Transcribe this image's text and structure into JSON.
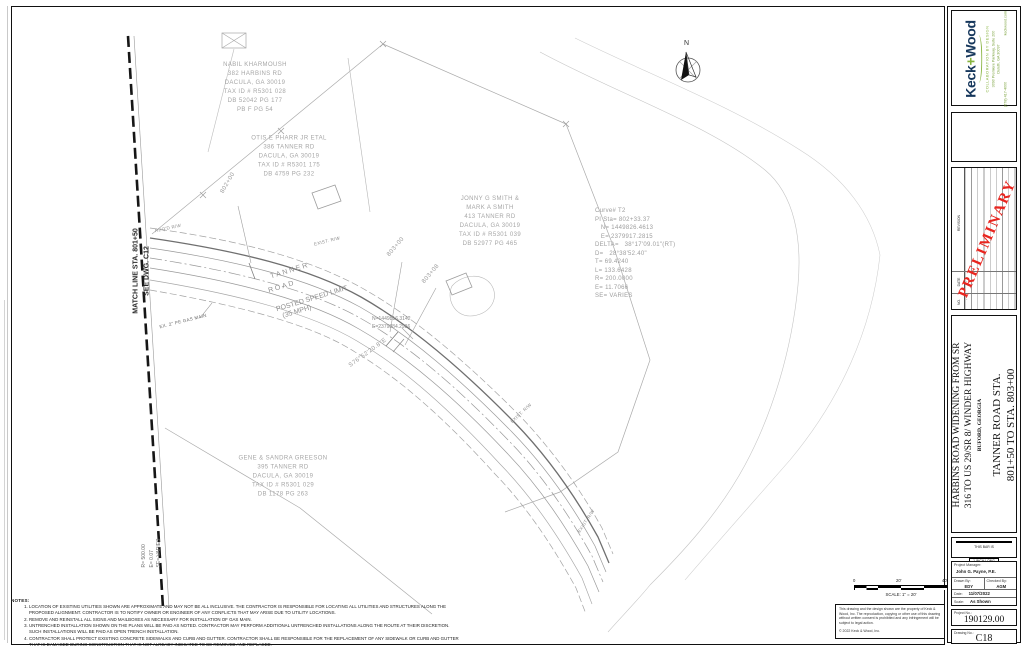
{
  "titleblock": {
    "firm": {
      "logo_part1": "Keck",
      "logo_part2": "+",
      "logo_part3": "Wood",
      "tagline": "COLLABORATION BY DESIGN",
      "address1": "3090 Premiere Parkway, Suite 200",
      "address2": "Duluth, GA 30097",
      "phone": "(678) 417-4000",
      "website": "keckwood.com"
    },
    "revision_table": {
      "headers": [
        "NO.",
        "DATE",
        "REVISION"
      ],
      "dash": "-",
      "preliminary": "PRELIMINARY"
    },
    "project_title_line1": "HARBINS ROAD WIDENING FROM SR",
    "project_title_line2": "316 TO US 29/SR 8/ WINDER HIGHWAY",
    "project_location": "BUFORD, GEORGIA",
    "sheet_title_line1": "TANNER ROAD STA.",
    "sheet_title_line2": "801+50 TO STA. 803+00",
    "bar_scale": {
      "line1": "THIS BAR IS",
      "line2": "1 INCH LONG",
      "line3": "PLOTTED FULL SCALE"
    },
    "info": {
      "project_manager_label": "Project Manager:",
      "project_manager": "John G. Payne, P.E.",
      "drawn_by_label": "Drawn By:",
      "drawn_by": "EDY",
      "checked_by_label": "Checked By:",
      "checked_by": "AGM",
      "date_label": "Date:",
      "date": "11/07/2022",
      "scale_label": "Scale:",
      "scale": "As Shown"
    },
    "project_no_label": "Project No.:",
    "project_no": "190129.00",
    "drawing_no_label": "Drawing No.:",
    "drawing_no": "C18"
  },
  "plan": {
    "north_label": "N",
    "match_line": {
      "line1": "MATCH LINE STA. 801+50",
      "line2": "SEE DWG. C12"
    },
    "parcels": [
      {
        "id": "kharmoush",
        "lines": [
          "NABIL KHARMOUSH",
          "382 HARBINS RD",
          "DACULA, GA 30019",
          "TAX ID # R5301 028",
          "DB 52042 PG 177",
          "PB F PG 54"
        ]
      },
      {
        "id": "pharr",
        "lines": [
          "OTIS E PHARR JR ETAL",
          "386 TANNER RD",
          "DACULA, GA 30019",
          "TAX ID # R5301 175",
          "DB 4759 PG 232"
        ]
      },
      {
        "id": "smith",
        "lines": [
          "JONNY G SMITH &",
          "MARK A SMITH",
          "413 TANNER RD",
          "DACULA, GA 30019",
          "TAX ID # R5301 039",
          "DB 52977 PG 465"
        ]
      },
      {
        "id": "greeson",
        "lines": [
          "GENE & SANDRA GREESON",
          "395 TANNER RD",
          "DACULA, GA 30019",
          "TAX ID # R5301 029",
          "DB 1178 PG 263"
        ]
      }
    ],
    "curve_table": {
      "lines": [
        "Curve# T2",
        "PI Sta= 802+33.37",
        "   N= 1449826.4613",
        "   E= 2379917.2815",
        "DELTA=   38°17'09.01\"(RT)",
        "D=   28°38'52.40\"",
        "T= 69.4240",
        "L= 133.6428",
        "R= 200.0000",
        "E= 11.7066",
        "SE= VARIES"
      ]
    },
    "stations": {
      "s1": "802+00",
      "s2": "803+00",
      "s3": "803+08"
    },
    "road_label": {
      "l1": "TANNER",
      "l2": "ROAD",
      "l3": "POSTED SPEED LIMIT",
      "l4": "(35 MPH)"
    },
    "bearing": "S76°52'20.8\"E",
    "coord_callout": {
      "lines": [
        "N=1449816.3142",
        "E=2379884.2936"
      ]
    },
    "gas_main_label": "EX. 2\" PE GAS MAIN",
    "rw_labels": {
      "reqd": "REQ'D R/W",
      "exist": "EXIST. R/W"
    },
    "left_curve_note": {
      "lines": [
        "R= 500.00",
        "E= 0.07",
        "SE= VARIES"
      ]
    },
    "scale_bar": {
      "t0": "0",
      "t20": "20'",
      "t40": "40'",
      "caption": "SCALE: 1\" = 20'"
    },
    "copyright": {
      "para": "This drawing and the design shown are the property of Keck & Wood, Inc. The reproduction, copying or other use of this drawing without written consent is prohibited and any infringement will be subject to legal action.",
      "notice": "© 2022 Keck & Wood, Inc."
    }
  },
  "notes": {
    "title": "NOTES:",
    "items": [
      "LOCATION OF EXISTING UTILITIES SHOWN ARE APPROXIMATE AND MAY NOT BE ALL INCLUSIVE.  THE CONTRACTOR IS RESPONSIBLE FOR LOCATING ALL UTILITIES AND STRUCTURES ALONG THE PROPOSED ALIGNMENT. CONTRACTOR IS TO NOTIFY OWNER OR ENGINEER OF ANY CONFLICTS THAT MAY ARISE DUE TO UTILITY LOCATIONS.",
      "REMOVE AND REINSTALL ALL SIGNS AND MAILBOXES AS NECESSARY FOR INSTALLATION OF GAS MAIN.",
      "UNTRENCHED INSTALLATION SHOWN ON THE PLANS WILL BE PAID AS NOTED. CONTRACTOR MAY PERFORM ADDITIONAL UNTRENCHED INSTALLATIONS ALONG THE ROUTE AT THEIR DISCRETION. SUCH INSTALLATIONS WILL BE PAID AS OPEN TRENCH INSTALLATION.",
      "CONTRACTOR SHALL PROTECT EXISTING CONCRETE SIDEWALKS AND CURB AND GUTTER.  CONTRACTOR SHALL BE RESPONSIBLE FOR THE REPLACEMENT OF ANY SIDEWALK OR CURB AND GUTTER THAT IS DAMAGED DURING CONSTRUCTION THAT IS NOT ALREADY INDICATED TO BE REMOVED AND REPLACED."
    ]
  }
}
